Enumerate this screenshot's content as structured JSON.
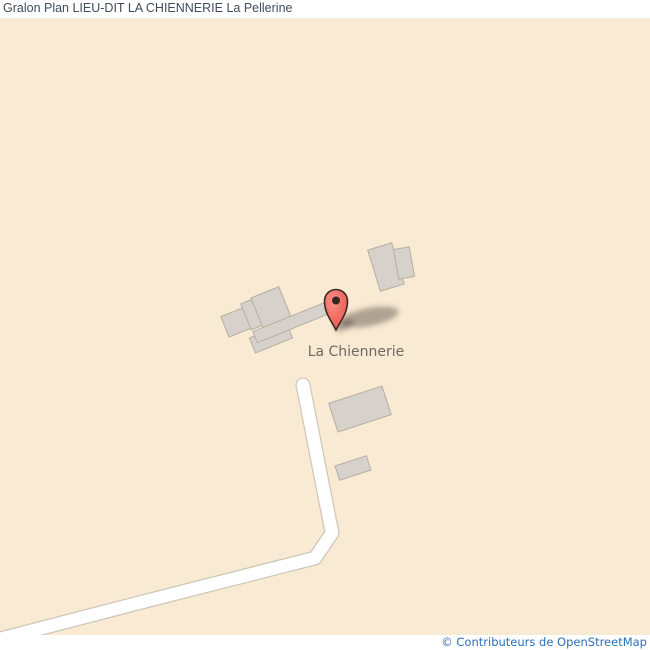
{
  "header": {
    "title": "Gralon Plan LIEU-DIT LA CHIENNERIE La Pellerine"
  },
  "map": {
    "place_label": "La Chiennerie",
    "marker_icon": "red-location-pin-icon",
    "colors": {
      "map_background": "#f9ead3",
      "road_fill": "#ffffff",
      "road_casing": "#cfc7ba",
      "building_fill": "#d6d1ca",
      "building_stroke": "#b9b2a5",
      "marker_red": "#f0695f",
      "marker_outline": "#3a2a24",
      "place_label_text": "#6e6a63",
      "title_text": "#414c5a",
      "attribution_link": "#2a70b8"
    }
  },
  "footer": {
    "attribution": "© Contributeurs de OpenStreetMap"
  }
}
